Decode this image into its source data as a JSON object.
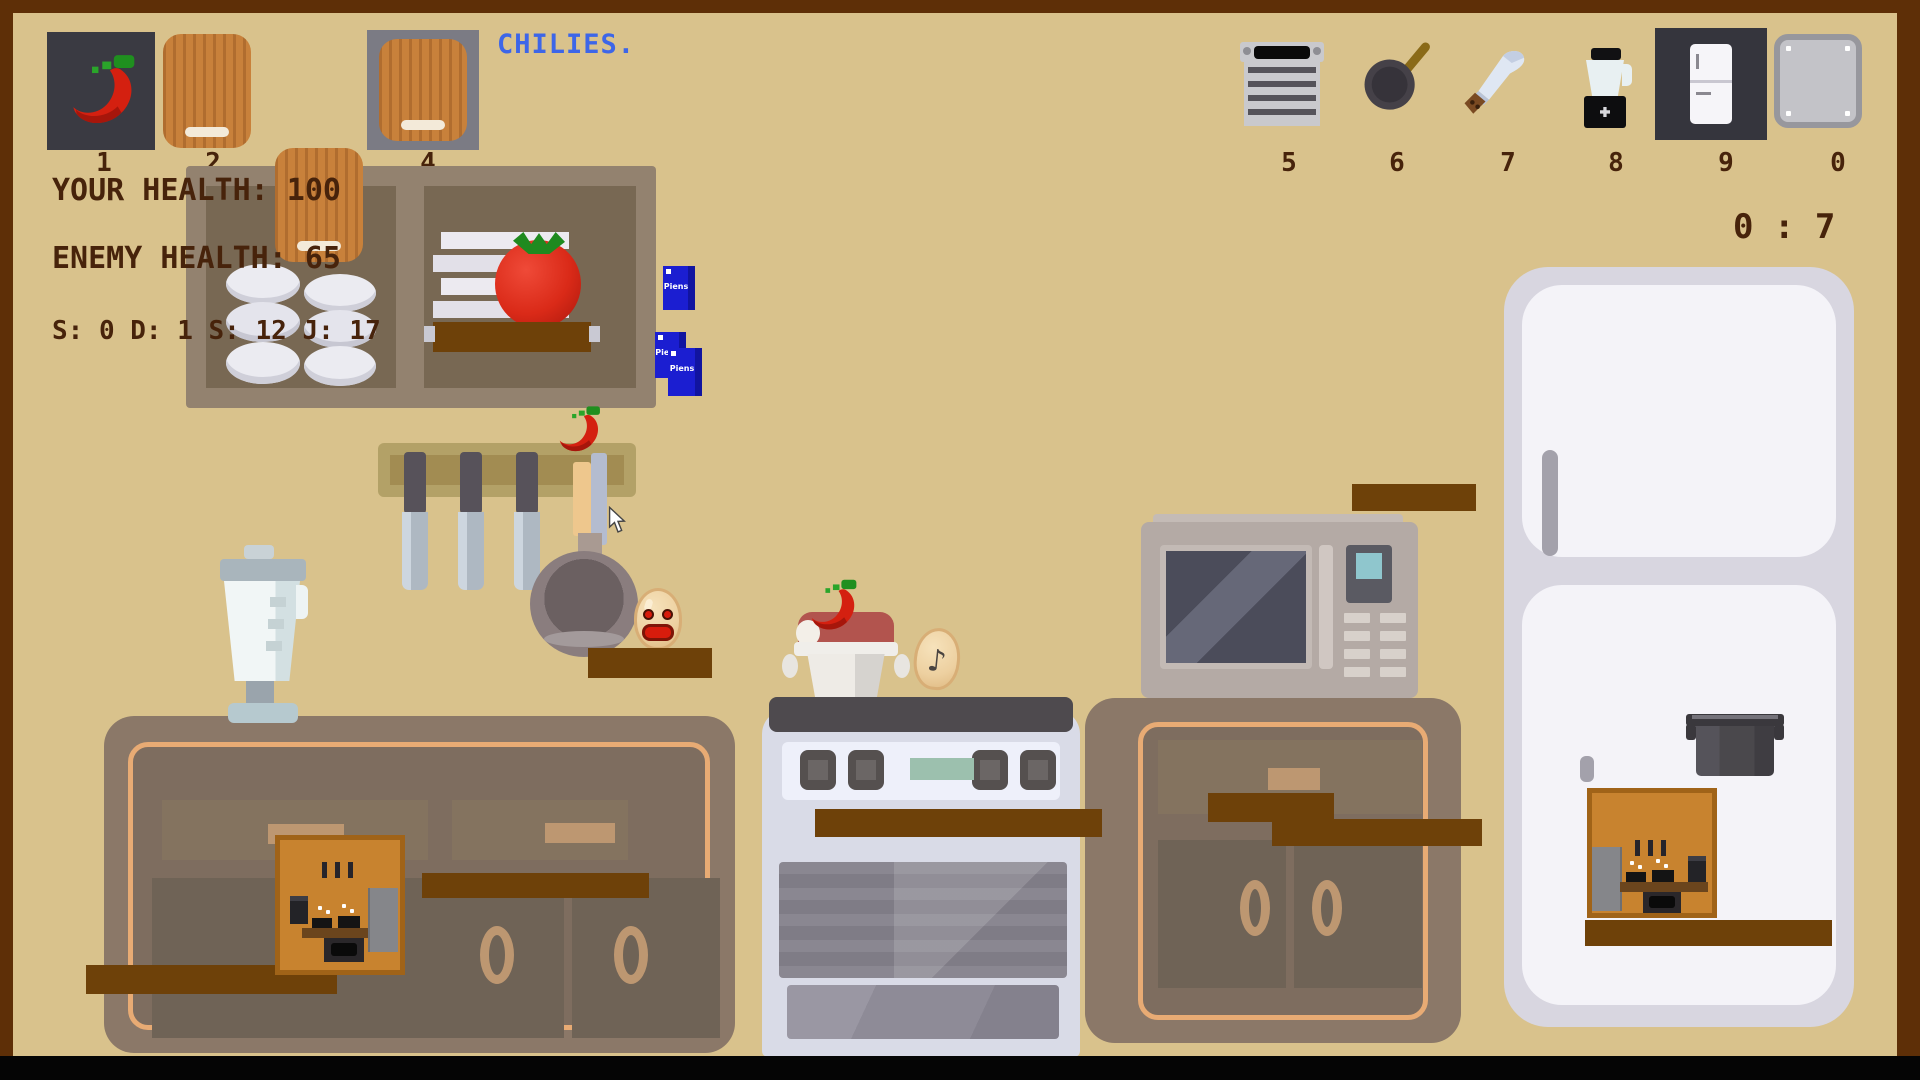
{
  "title": {
    "text": "CHILIES."
  },
  "hud": {
    "your_health": "YOUR HEALTH: 100",
    "enemy_health": "ENEMY HEALTH: 65",
    "stats": "S: 0 D: 1 S: 12 J: 17",
    "timer": "0 : 7",
    "slots": [
      {
        "key": "1",
        "item": "chili"
      },
      {
        "key": "2",
        "item": "cutting-board"
      },
      {
        "key": "3",
        "item": "cutting-board"
      },
      {
        "key": "4",
        "item": "cutting-board"
      },
      {
        "key": "5",
        "item": "grater"
      },
      {
        "key": "6",
        "item": "frying-pan"
      },
      {
        "key": "7",
        "item": "machete"
      },
      {
        "key": "8",
        "item": "blender"
      },
      {
        "key": "9",
        "item": "refrigerator"
      },
      {
        "key": "0",
        "item": "metal-plate"
      }
    ]
  },
  "scene": {
    "milk_label": "Piens"
  },
  "colors": {
    "background": "#d9c28c",
    "frame": "#5e2f07",
    "text_brown": "#47230b",
    "accent_blue": "#3d66e8",
    "plank_brown": "#6e4109",
    "chili_red": "#d42010",
    "milk_blue": "#1b1ed1"
  }
}
